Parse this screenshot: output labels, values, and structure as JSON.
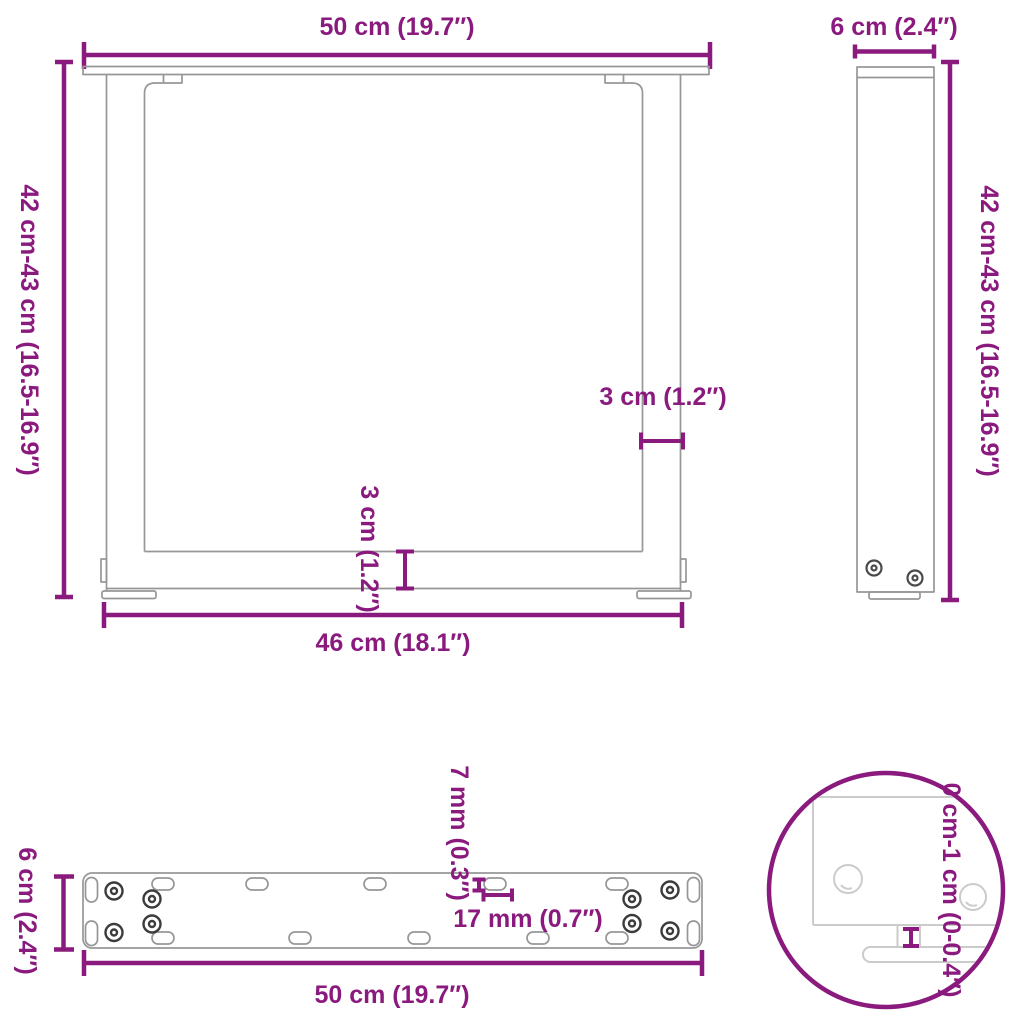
{
  "colors": {
    "accent": "#8A1A7E",
    "outline": "#979797",
    "screw": "#3C3C3C",
    "detail_outline": "#CBCBCB"
  },
  "front_view": {
    "width_label": "50 cm (19.7″)",
    "height_label": "42 cm-43 cm (16.5-16.9″)",
    "leg_width_label": "3 cm (1.2″)",
    "crossbar_label": "3 cm (1.2″)",
    "inner_width_label": "46 cm (18.1″)"
  },
  "side_view": {
    "depth_label": "6 cm (2.4″)",
    "height_label": "42 cm-43 cm (16.5-16.9″)"
  },
  "plate_view": {
    "depth_label": "6 cm (2.4″)",
    "length_label": "50 cm (19.7″)",
    "hole_width_label": "7 mm (0.3″)",
    "hole_length_label": "17 mm (0.7″)"
  },
  "detail_view": {
    "adjustable_height_label": "0 cm-1 cm (0-0.4″)"
  }
}
